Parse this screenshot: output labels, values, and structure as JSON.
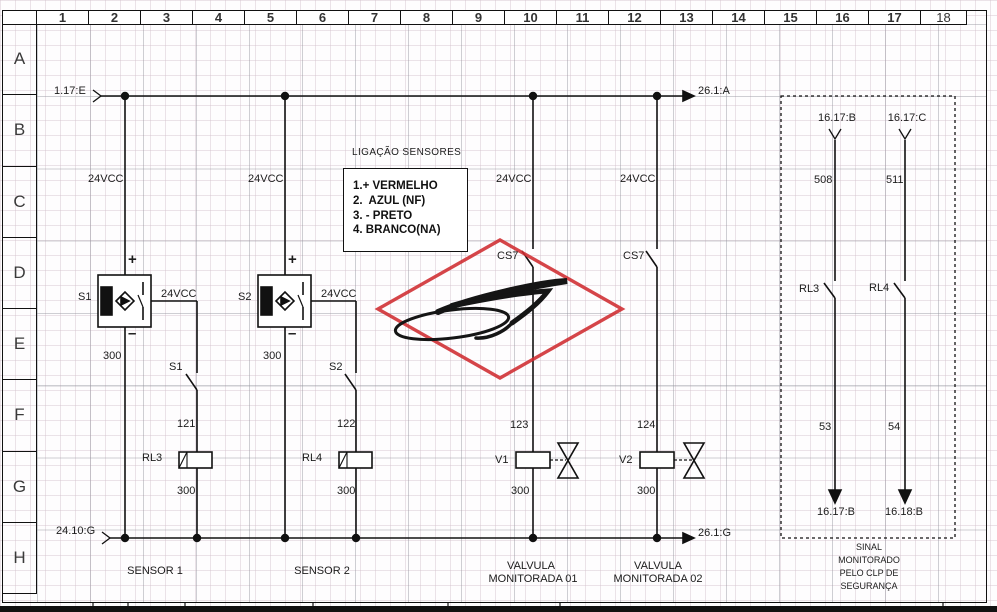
{
  "sheet": {
    "columns": [
      "1",
      "2",
      "3",
      "4",
      "5",
      "6",
      "7",
      "8",
      "9",
      "10",
      "11",
      "12",
      "13",
      "14",
      "15",
      "16",
      "17",
      "18"
    ],
    "rows": [
      "A",
      "B",
      "C",
      "D",
      "E",
      "F",
      "G",
      "H"
    ]
  },
  "rails": {
    "top_source": "1.17:E",
    "top_dest": "26.1:A",
    "bottom_source": "24.10:G",
    "bottom_dest": "26.1:G"
  },
  "legend": {
    "title": "LIGAÇÃO SENSORES",
    "lines": [
      "1.+ VERMELHO",
      "2.  AZUL (NF)",
      "3. - PRETO",
      "4. BRANCO(NA)"
    ]
  },
  "sensors": [
    {
      "supply": "24VCC",
      "plus": "+",
      "minus": "–",
      "tag": "S1",
      "wire_below": "300",
      "out": "24VCC",
      "contact_tag": "S1",
      "contact_wire": "121",
      "coil_tag": "RL3",
      "coil_wire": "300",
      "caption": "SENSOR 1"
    },
    {
      "supply": "24VCC",
      "plus": "+",
      "minus": "–",
      "tag": "S2",
      "wire_below": "300",
      "out": "24VCC",
      "contact_tag": "S2",
      "contact_wire": "122",
      "coil_tag": "RL4",
      "coil_wire": "300",
      "caption": "SENSOR 2"
    }
  ],
  "valves": [
    {
      "supply": "24VCC",
      "contact_tag": "CS7",
      "wire": "123",
      "coil_tag": "V1",
      "coil_wire": "300",
      "caption_line1": "VALVULA",
      "caption_line2": "MONITORADA 01"
    },
    {
      "supply": "24VCC",
      "contact_tag": "CS7",
      "wire": "124",
      "coil_tag": "V2",
      "coil_wire": "300",
      "caption_line1": "VALVULA",
      "caption_line2": "MONITORADA 02"
    }
  ],
  "monitor_box": {
    "channels": [
      {
        "from": "16.17:B",
        "wire_in": "508",
        "contact_tag": "RL3",
        "wire_out": "53",
        "to": "16.17:B"
      },
      {
        "from": "16.17:C",
        "wire_in": "511",
        "contact_tag": "RL4",
        "wire_out": "54",
        "to": "16.18:B"
      }
    ],
    "caption_lines": [
      "SINAL",
      "MONITORADO",
      "PELO CLP DE",
      "SEGURANÇA"
    ]
  },
  "colors": {
    "stamp_red": "#cf2b30",
    "line": "#111111"
  }
}
